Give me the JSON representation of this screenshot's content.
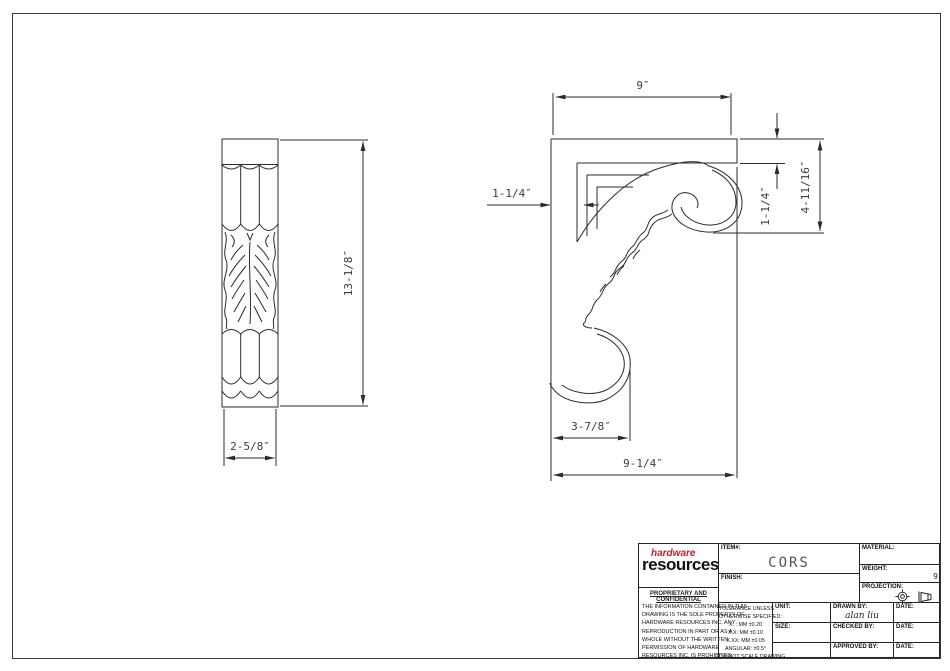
{
  "drawing": {
    "item_name": "CORS corbel technical drawing",
    "dims": {
      "front_height": "13-1/8″",
      "front_width": "2-5/8″",
      "side_top_length": "9″",
      "side_back_thickness": "1-1/4″",
      "side_bar_thickness": "1-1/4″",
      "side_upper_drop": "4-11/16″",
      "side_foot_depth": "3-7/8″",
      "side_overall_depth": "9-1/4″"
    }
  },
  "title_block": {
    "logo": {
      "line1": "hardware",
      "line2": "resources",
      "accent_color": "#c8202a"
    },
    "proprietary_title": "PROPRIETARY AND CONFIDENTIAL",
    "proprietary_lines": [
      "THE INFORMATION CONTAINED IN THIS",
      "DRAWING IS THE SOLE PROPERTY OF",
      "HARDWARE RESOURCES INC.  ANY",
      "REPRODUCTION IN PART OR AS A",
      "WHOLE  WITHOUT THE WRITTEN",
      "PERMISSION OF HARDWARE",
      "RESOURCES INC. IS PROHIBITED."
    ],
    "item_label": "ITEM#:",
    "item_value": "CORS",
    "finish_label": "FINISH:",
    "material_label": "MATERIAL:",
    "weight_label": "WEIGHT:",
    "weight_value": "9",
    "projection_label": "PROJECTION:",
    "tolerance_lines": [
      "TOLERANCE UNLESS",
      "OTHERWISE SPECIFIED:",
      "X. : MM  ±0.20",
      "X.X: MM  ±0.10",
      "X.XX: MM  ±0.05",
      "ANGULAR:  ±0.5°",
      "DO NOT SCALE DRAWING"
    ],
    "unit_label": "UNIT:",
    "size_label": "SIZE:",
    "drawn_by_label": "DRAWN BY:",
    "drawn_by_value": "alan liu",
    "checked_by_label": "CHECKED BY:",
    "approved_by_label": "APPROVED BY:",
    "date_label": "DATE:"
  }
}
